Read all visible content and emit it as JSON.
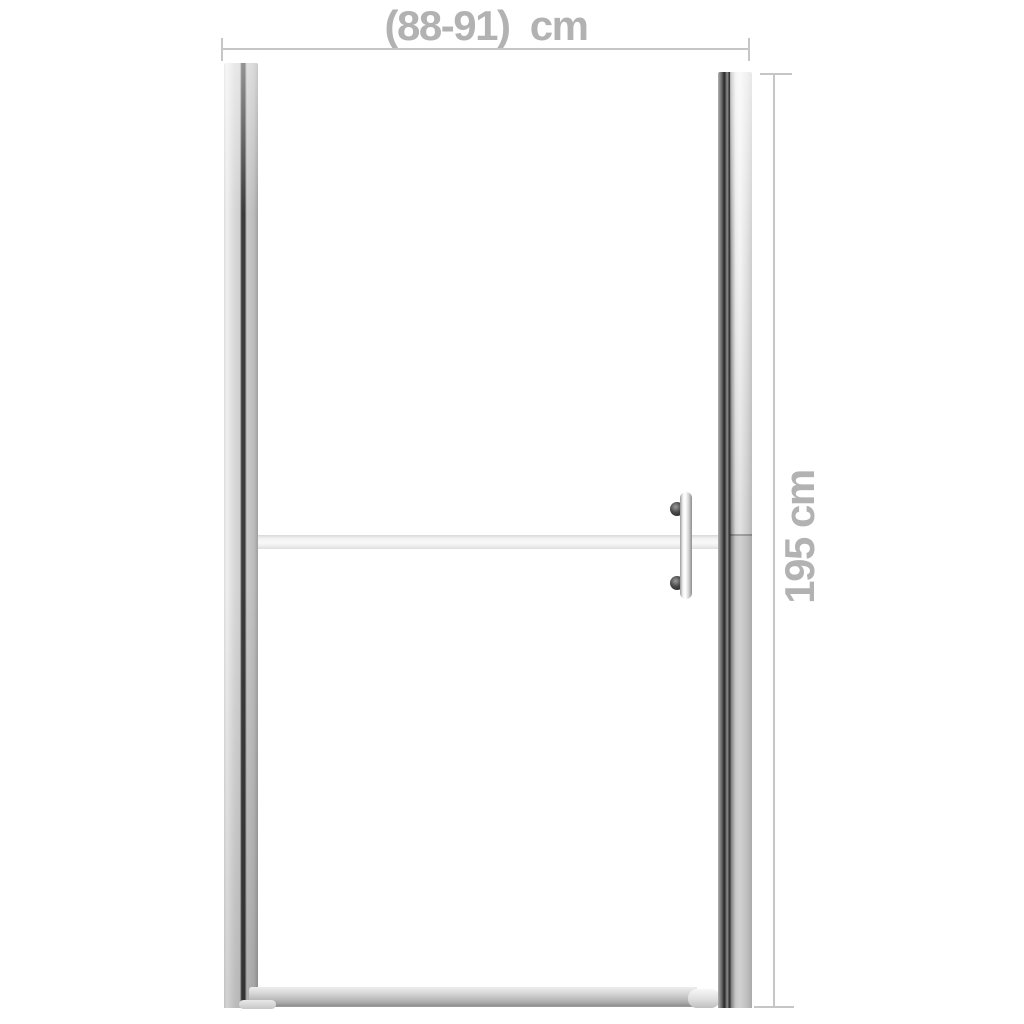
{
  "diagram": {
    "dimensions": {
      "width": {
        "label": "(88-91)  cm"
      },
      "height": {
        "label": "195 cm"
      }
    },
    "colors": {
      "background": "#ffffff",
      "dimension_line": "#c6c6c6",
      "dimension_text": "#b2b2b2",
      "frame_metal_light": "#efefef",
      "frame_metal_dark": "#2c2c2c",
      "frost_band": "#f2f2f2",
      "handle_knob": "#1c1c1c"
    }
  }
}
